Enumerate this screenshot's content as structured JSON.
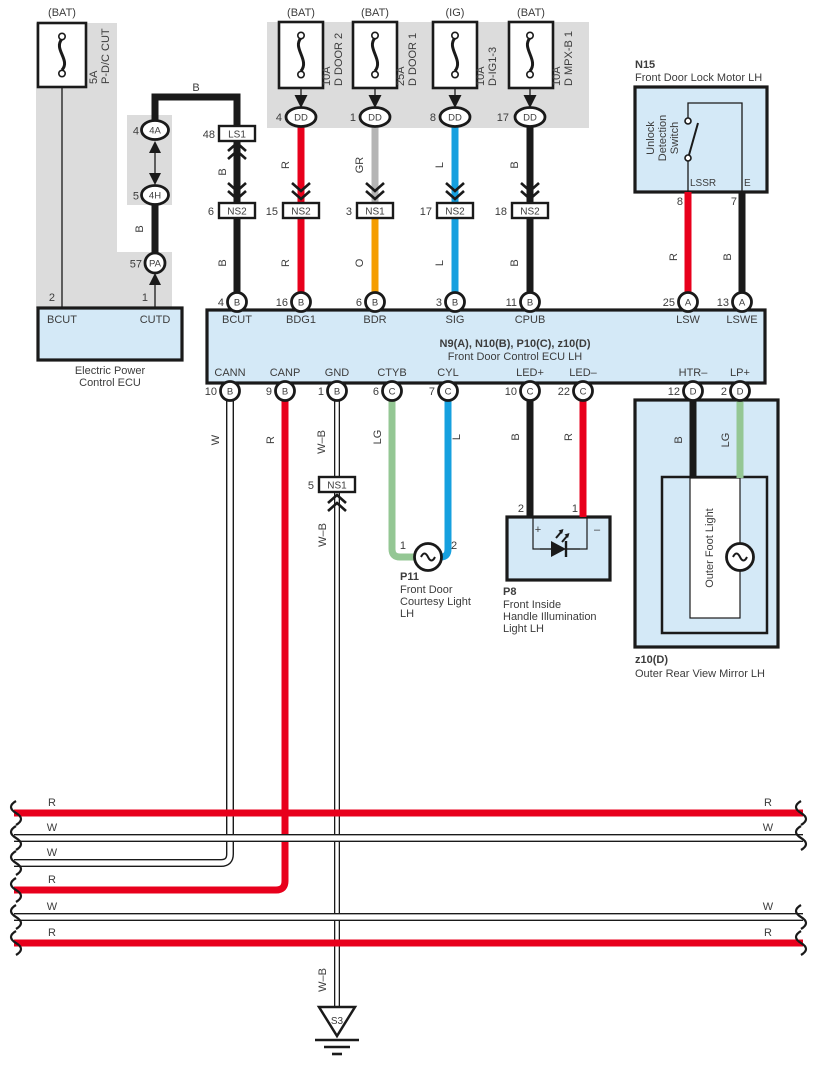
{
  "fuses": [
    {
      "tag": "(BAT)",
      "amp": "5A",
      "name": "P-D/C CUT"
    },
    {
      "tag": "(BAT)",
      "amp": "10A",
      "name": "D DOOR 2",
      "pin": "4",
      "conn": "DD"
    },
    {
      "tag": "(BAT)",
      "amp": "25A",
      "name": "D DOOR 1",
      "pin": "1",
      "conn": "DD"
    },
    {
      "tag": "(IG)",
      "amp": "10A",
      "name": "D-IG1-3",
      "pin": "8",
      "conn": "DD"
    },
    {
      "tag": "(BAT)",
      "amp": "10A",
      "name": "D MPX-B 1",
      "pin": "17",
      "conn": "DD"
    }
  ],
  "junctions": {
    "j4a": {
      "num": "4",
      "label": "4A"
    },
    "j4h": {
      "num": "5",
      "label": "4H"
    },
    "jpa": {
      "num": "57",
      "label": "PA"
    },
    "ls1": {
      "num": "48",
      "label": "LS1"
    },
    "ns2a": {
      "num": "6",
      "label": "NS2"
    },
    "ns2b": {
      "num": "15",
      "label": "NS2"
    },
    "ns1a": {
      "num": "3",
      "label": "NS1"
    },
    "ns2c": {
      "num": "17",
      "label": "NS2"
    },
    "ns2d": {
      "num": "18",
      "label": "NS2"
    },
    "ns1b": {
      "num": "5",
      "label": "NS1"
    }
  },
  "epcu": {
    "pin2": "2",
    "pin1": "1",
    "bcut": "BCUT",
    "cutd": "CUTD",
    "line1": "Electric Power",
    "line2": "Control ECU"
  },
  "ecu": {
    "title_bold": "N9(A), N10(B), P10(C), z10(D)",
    "title": "Front Door Control ECU LH",
    "top_pins": [
      {
        "num": "4",
        "letter": "B",
        "name": "BCUT"
      },
      {
        "num": "16",
        "letter": "B",
        "name": "BDG1"
      },
      {
        "num": "6",
        "letter": "B",
        "name": "BDR"
      },
      {
        "num": "3",
        "letter": "B",
        "name": "SIG"
      },
      {
        "num": "11",
        "letter": "B",
        "name": "CPUB"
      },
      {
        "num": "25",
        "letter": "A",
        "name": "LSW"
      },
      {
        "num": "13",
        "letter": "A",
        "name": "LSWE"
      }
    ],
    "bottom_pins": [
      {
        "num": "10",
        "letter": "B",
        "name": "CANN"
      },
      {
        "num": "9",
        "letter": "B",
        "name": "CANP"
      },
      {
        "num": "1",
        "letter": "B",
        "name": "GND"
      },
      {
        "num": "6",
        "letter": "C",
        "name": "CTYB"
      },
      {
        "num": "7",
        "letter": "C",
        "name": "CYL"
      },
      {
        "num": "10",
        "letter": "C",
        "name": "LED+"
      },
      {
        "num": "22",
        "letter": "C",
        "name": "LED–"
      },
      {
        "num": "12",
        "letter": "D",
        "name": "HTR–"
      },
      {
        "num": "2",
        "letter": "D",
        "name": "LP+"
      }
    ]
  },
  "n15": {
    "id": "N15",
    "name": "Front Door Lock Motor LH",
    "sw1": "Unlock",
    "sw2": "Detection",
    "sw3": "Switch",
    "lssr": "LSSR",
    "e": "E",
    "num8": "8",
    "num7": "7"
  },
  "p11": {
    "id": "P11",
    "line1": "Front Door",
    "line2": "Courtesy Light",
    "line3": "LH",
    "pin1": "1",
    "pin2": "2"
  },
  "p8": {
    "id": "P8",
    "line1": "Front Inside",
    "line2": "Handle Illumination",
    "line3": "Light LH",
    "plus": "+",
    "minus": "–",
    "num2": "2",
    "num1": "1"
  },
  "z10": {
    "id": "z10(D)",
    "name": "Outer Rear View Mirror LH",
    "inner": "Outer Foot Light"
  },
  "ground": {
    "id": "S3"
  },
  "wire_labels": {
    "b_top": "B",
    "b_mid": "B",
    "b_ls1": "B",
    "b_bcut": "B",
    "r1": "R",
    "r2": "R",
    "gr": "GR",
    "o": "O",
    "l1": "L",
    "l2": "L",
    "b1": "B",
    "b2": "B",
    "r_lsw": "R",
    "b_lswe": "B",
    "w_cann": "W",
    "r_canp": "R",
    "wb_top": "W–B",
    "wb_mid": "W–B",
    "wb_bot": "W–B",
    "lg_ctyb": "LG",
    "l_cyl": "L",
    "b_led": "B",
    "r_led": "R",
    "b_htr": "B",
    "lg_lp": "LG"
  },
  "bus": {
    "r1l": "R",
    "r1r": "R",
    "w2l": "W",
    "w2r": "W",
    "w3l": "W",
    "r4l": "R",
    "w5l": "W",
    "w5r": "W",
    "r6l": "R",
    "r6r": "R"
  },
  "colors": {
    "red": "#e8001c",
    "blue": "#16a0df",
    "orange": "#f59d00",
    "green": "#94c794",
    "gray_wire": "#b5b5b5",
    "panel_blue": "#d4e9f7",
    "shade": "#dcdcdc",
    "black": "#1a1a1a"
  }
}
